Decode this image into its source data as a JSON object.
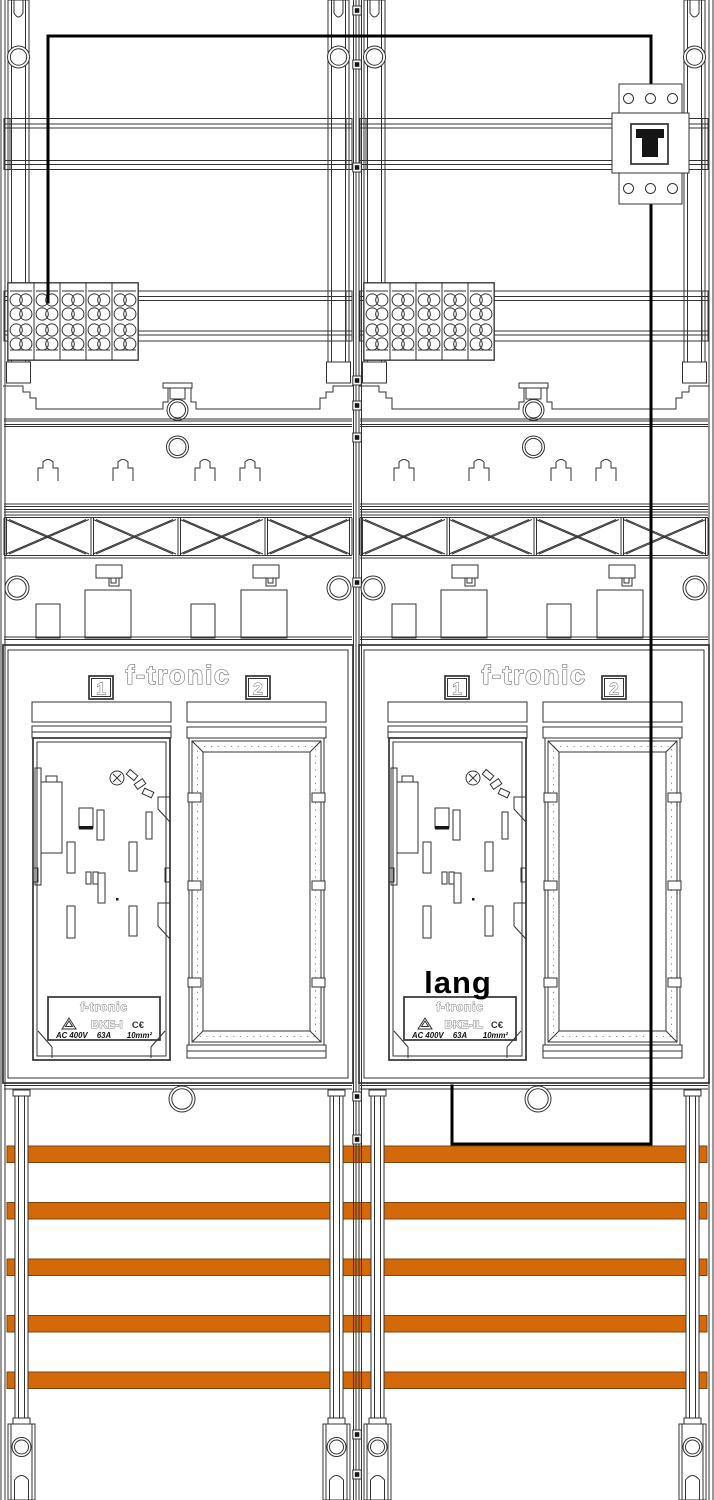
{
  "drawing": {
    "type": "electrical-meter-board-technical-drawing",
    "colors": {
      "line": "#333333",
      "wire": "#000000",
      "busbar": "#d4690a",
      "busbar_border": "#7c4508"
    },
    "busbars": {
      "count": 5
    },
    "terminal_block": {
      "columns": 5,
      "rows": 4,
      "circles_per_row": 2
    },
    "panels": [
      {
        "header": "f-tronic",
        "slot1": "1",
        "slot2": "2",
        "annotation": "",
        "plate": {
          "brand": "f-tronic",
          "model": "BKE-I",
          "ce": "C€",
          "voltage": "AC 400V",
          "current": "63A",
          "cross_section": "10mm²"
        }
      },
      {
        "header": "f-tronic",
        "slot1": "1",
        "slot2": "2",
        "annotation": "lang",
        "plate": {
          "brand": "f-tronic",
          "model": "BKE-IL",
          "ce": "C€",
          "voltage": "AC 400V",
          "current": "63A",
          "cross_section": "10mm²"
        }
      }
    ]
  }
}
